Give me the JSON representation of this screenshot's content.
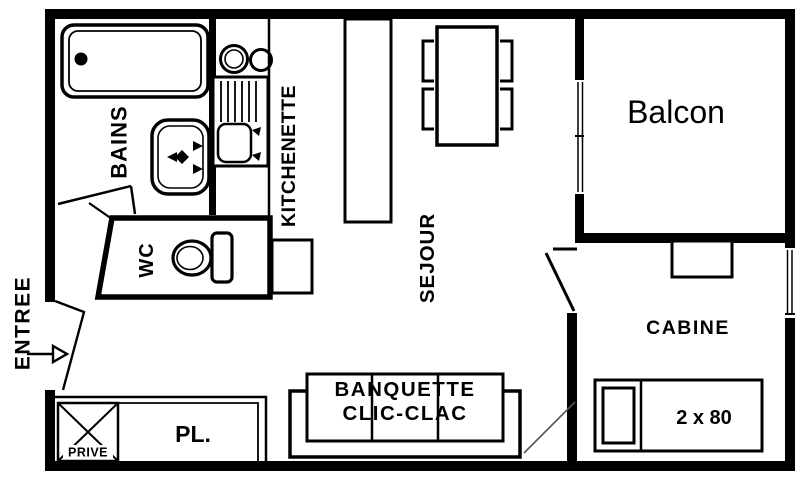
{
  "title": "Studio apartment floor plan",
  "colors": {
    "wall": "#000000",
    "background": "#ffffff",
    "swing_line": "#555555"
  },
  "rooms": {
    "entree": "ENTREE",
    "bains": "BAINS",
    "kitchenette": "KITCHENETTE",
    "wc": "WC",
    "sejour": "SEJOUR",
    "balcon": "Balcon",
    "cabine": "CABINE",
    "placard": "PL.",
    "prive": "PRIVE"
  },
  "furniture": {
    "banquette_line1": "BANQUETTE",
    "banquette_line2": "CLIC-CLAC",
    "bed_size": "2 x 80"
  }
}
